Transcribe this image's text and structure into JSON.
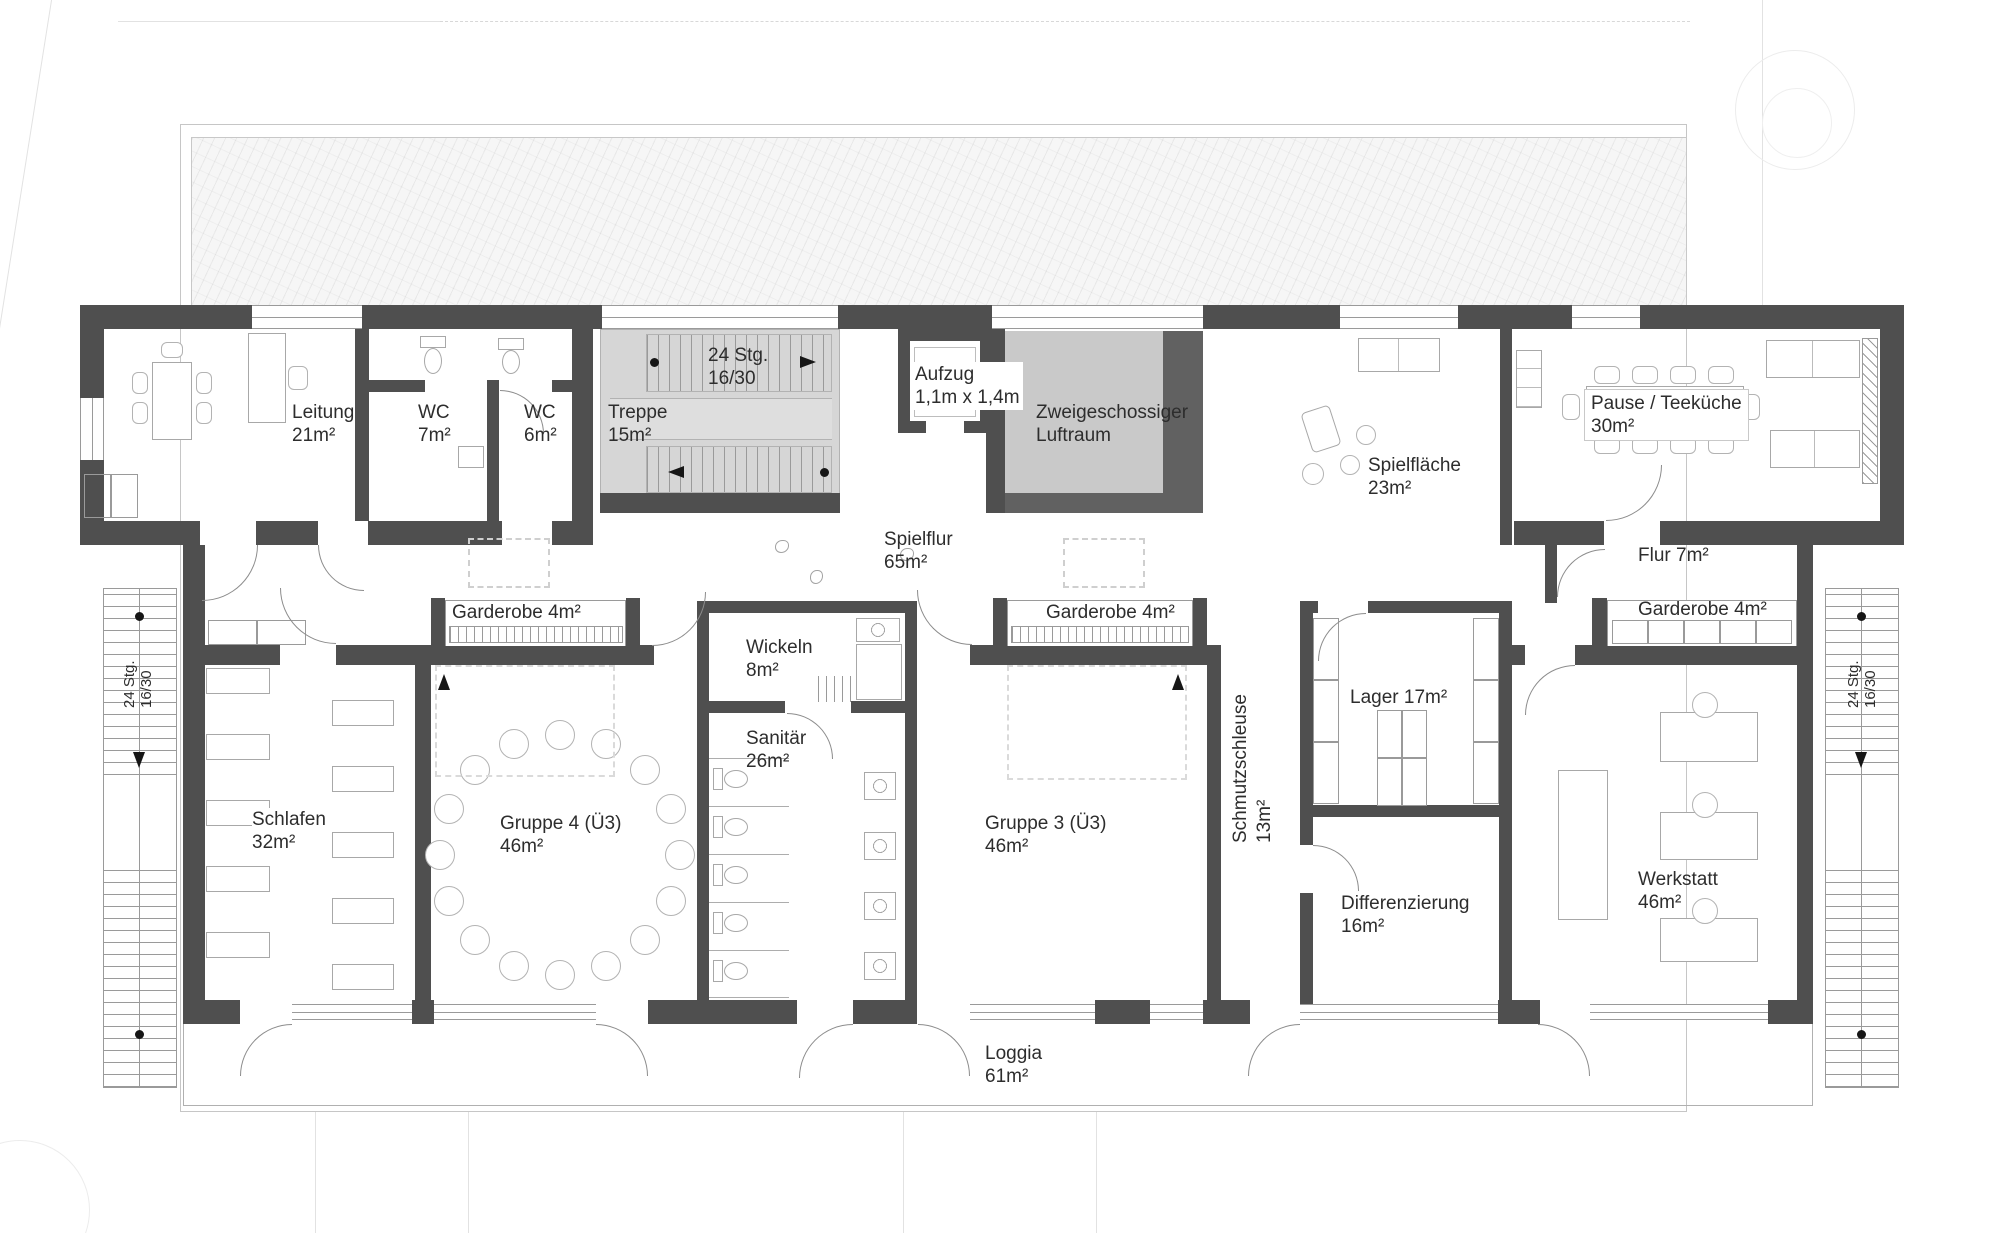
{
  "colors": {
    "wall": "#4f4f4f",
    "void_fill": "#c9c9c9",
    "stair_fill": "#d6d6d6",
    "hatch_bg": "#f6f6f6",
    "line": "#9a9a9a",
    "text": "#2d2d2d"
  },
  "rooms": {
    "leitung": {
      "line1": "Leitung",
      "line2": "21m²"
    },
    "wc7": {
      "line1": "WC",
      "line2": "7m²"
    },
    "wc6": {
      "line1": "WC",
      "line2": "6m²"
    },
    "treppe": {
      "line1": "Treppe",
      "line2": "15m²"
    },
    "treppe_stairs": {
      "line1": "24 Stg.",
      "line2": "16/30"
    },
    "aufzug": {
      "line1": "Aufzug",
      "line2": "1,1m x 1,4m"
    },
    "luftraum": {
      "line1": "Zweigeschossiger",
      "line2": "Luftraum"
    },
    "spielflur": {
      "line1": "Spielflur",
      "line2": "65m²"
    },
    "spielflaeche": {
      "line1": "Spielfläche",
      "line2": "23m²"
    },
    "pause": {
      "line1": "Pause / Teeküche",
      "line2": "30m²"
    },
    "flur": {
      "line1": "Flur 7m²"
    },
    "garderobe_left": {
      "line1": "Garderobe 4m²"
    },
    "garderobe_mid": {
      "line1": "Garderobe 4m²"
    },
    "garderobe_right": {
      "line1": "Garderobe 4m²"
    },
    "wickeln": {
      "line1": "Wickeln",
      "line2": "8m²"
    },
    "sanitaer": {
      "line1": "Sanitär",
      "line2": "26m²"
    },
    "schlafen": {
      "line1": "Schlafen",
      "line2": "32m²"
    },
    "gruppe4": {
      "line1": "Gruppe 4 (Ü3)",
      "line2": "46m²"
    },
    "gruppe3": {
      "line1": "Gruppe 3 (Ü3)",
      "line2": "46m²"
    },
    "schmutzschleuse": {
      "line1": "Schmutzschleuse",
      "line2": "13m²"
    },
    "lager": {
      "line1": "Lager 17m²"
    },
    "differenzierung": {
      "line1": "Differenzierung",
      "line2": "16m²"
    },
    "werkstatt": {
      "line1": "Werkstatt",
      "line2": "46m²"
    },
    "loggia": {
      "line1": "Loggia",
      "line2": "61m²"
    },
    "stairs_left": {
      "line1": "24 Stg.",
      "line2": "16/30"
    },
    "stairs_right": {
      "line1": "24 Stg.",
      "line2": "16/30"
    }
  }
}
